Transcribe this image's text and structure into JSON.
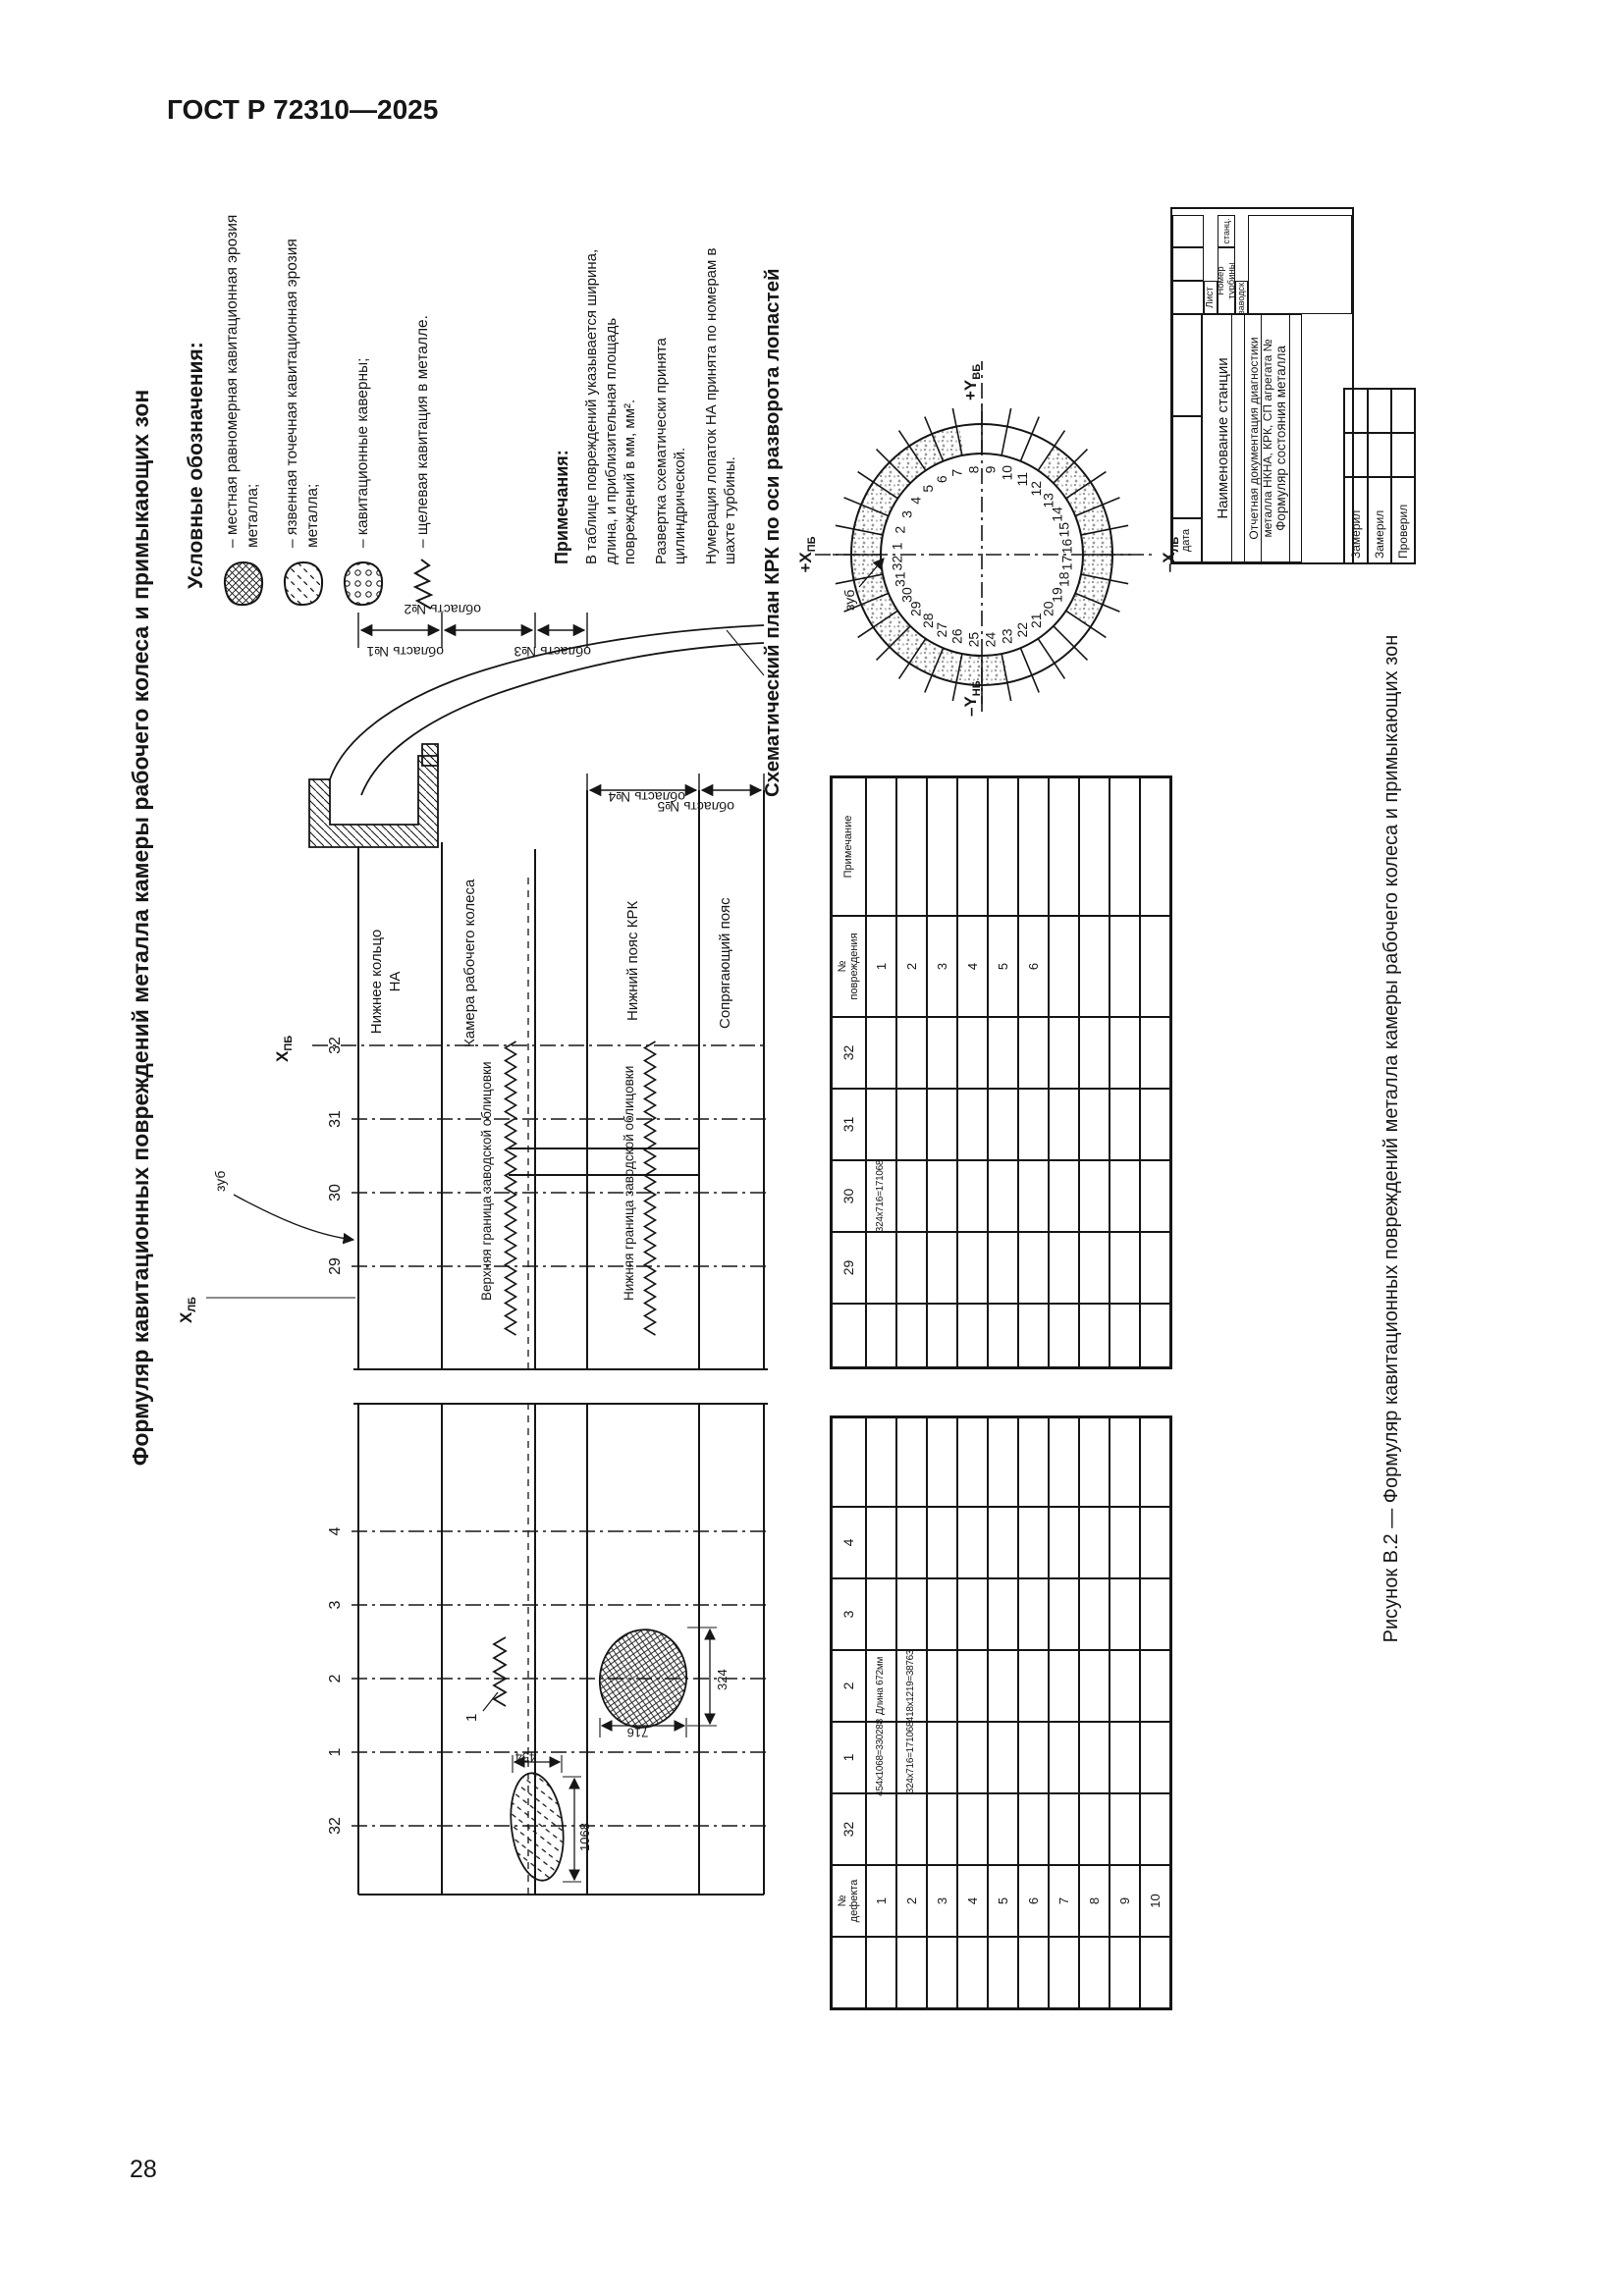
{
  "page": {
    "header": "ГОСТ Р 72310—2025",
    "page_number": "28"
  },
  "figure": {
    "title": "Формуляр кавитационных повреждений металла камеры рабочего колеса и примыкающих зон",
    "caption": "Рисунок В.2 — Формуляр кавитационных повреждений металла камеры рабочего колеса и примыкающих зон"
  },
  "legend": {
    "heading": "Условные обозначения:",
    "items": [
      {
        "icon": "crosshatch-blob-icon",
        "label": "– местная равномерная кавитационная эрозия металла;"
      },
      {
        "icon": "pitting-blob-icon",
        "label": "– язвенная точечная кавитационная эрозия металла;"
      },
      {
        "icon": "caverns-blob-icon",
        "label": "– кавитационные каверны;"
      },
      {
        "icon": "zigzag-line-icon",
        "label": "– щелевая кавитация в металле."
      }
    ]
  },
  "notes": {
    "heading": "Примечания:",
    "items": [
      "В таблице повреждений указывается ширина, длина, и приблизительная площадь повреждений в мм, мм².",
      "Развертка схематически принята цилиндрической.",
      "Нумерация лопаток НА принята по номерам в шахте турбины."
    ]
  },
  "plan": {
    "heading": "Схематический план КРК по оси разворота лопастей",
    "blade_count": 32,
    "axis_top": {
      "text": "+Х",
      "sub": "ПБ"
    },
    "axis_bottom": {
      "text": "–Х",
      "sub": "ЛБ"
    },
    "axis_left": {
      "text": "–Y",
      "sub": "НБ"
    },
    "axis_right": {
      "text": "+Y",
      "sub": "ВБ"
    },
    "tooth_label": "зуб"
  },
  "development": {
    "axis_right": {
      "text": "Х",
      "sub": "ПБ"
    },
    "axis_left": {
      "text": "Х",
      "sub": "ЛБ"
    },
    "left_blades": [
      "32",
      "1",
      "2",
      "3",
      "4"
    ],
    "right_blades": [
      "29",
      "30",
      "31",
      "32"
    ],
    "tooth_label": "зуб",
    "bands": {
      "ring": "Нижнее кольцо НА",
      "chamber": "Камера рабочего колеса",
      "lower_belt": "Нижний пояс КРК",
      "mating_belt": "Сопрягающий пояс"
    },
    "boundaries": {
      "upper": "Верхняя граница заводской облицовки",
      "lower": "Нижняя граница заводской облицовки"
    },
    "zones": [
      "область №1",
      "область №2",
      "область №3",
      "область №4",
      "область №5"
    ],
    "dims": {
      "d454": "454",
      "d1068": "1068",
      "d716": "716",
      "d324": "324"
    },
    "defect_callout": "1"
  },
  "tables": {
    "left": {
      "headers": [
        "",
        "№\nдефекта",
        "32",
        "1",
        "2",
        "3",
        "4",
        ""
      ],
      "row_numbers": [
        "1",
        "2",
        "3",
        "4",
        "5",
        "6",
        "7",
        "8",
        "9",
        "10"
      ],
      "cells": {
        "1:3": "454х1068=330288",
        "1:4": "Длина 672мм",
        "2:3": "324х716=171068",
        "2:4": "418х1219=38763"
      }
    },
    "right": {
      "headers": [
        "",
        "29",
        "30",
        "31",
        "32",
        "№\nповреждения",
        "Примечание"
      ],
      "row_numbers": [
        "1",
        "2",
        "3",
        "4",
        "5",
        "6",
        "",
        "",
        "",
        ""
      ],
      "cells": {
        "1:2": "324х716=171068"
      }
    }
  },
  "stamp": {
    "date_label": "дата",
    "station_label": "Наименование станции",
    "doc_label": "Отчетная документация диагностики металла НКНА, КРК, СП агрегата №",
    "form_label": "Формуляр состояния металла",
    "turbine_label": "Номер турбины",
    "col_stanc": "станц.",
    "col_zavod": "заводск.",
    "sheet_label": "Лист",
    "sign_rows": [
      "Замерил",
      "Замерил",
      "Проверил"
    ]
  }
}
